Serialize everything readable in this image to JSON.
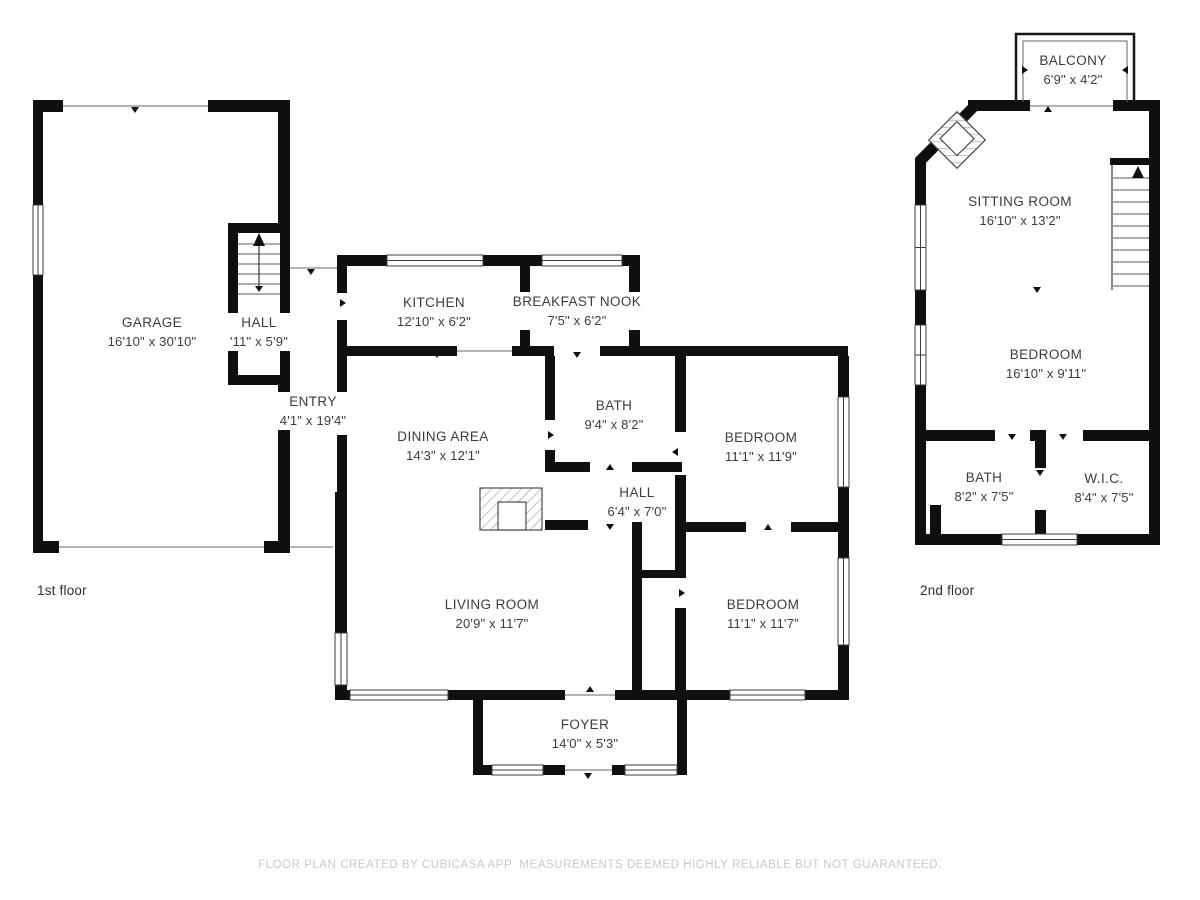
{
  "floors": [
    {
      "caption": "1st floor",
      "rooms": [
        {
          "id": "garage",
          "name": "GARAGE",
          "dims": "16'10\" x 30'10\""
        },
        {
          "id": "stair-hall",
          "name": "HALL",
          "dims": "'11\" x 5'9\""
        },
        {
          "id": "entry",
          "name": "ENTRY",
          "dims": "4'1\" x 19'4\""
        },
        {
          "id": "kitchen",
          "name": "KITCHEN",
          "dims": "12'10\" x 6'2\""
        },
        {
          "id": "breakfast-nook",
          "name": "BREAKFAST NOOK",
          "dims": "7'5\" x 6'2\""
        },
        {
          "id": "dining-area",
          "name": "DINING AREA",
          "dims": "14'3\" x 12'1\""
        },
        {
          "id": "bath",
          "name": "BATH",
          "dims": "9'4\" x 8'2\""
        },
        {
          "id": "hall",
          "name": "HALL",
          "dims": "6'4\" x 7'0\""
        },
        {
          "id": "bedroom-1",
          "name": "BEDROOM",
          "dims": "11'1\" x 11'9\""
        },
        {
          "id": "living-room",
          "name": "LIVING ROOM",
          "dims": "20'9\" x 11'7\""
        },
        {
          "id": "bedroom-2",
          "name": "BEDROOM",
          "dims": "11'1\" x 11'7\""
        },
        {
          "id": "foyer",
          "name": "FOYER",
          "dims": "14'0\" x 5'3\""
        }
      ]
    },
    {
      "caption": "2nd floor",
      "rooms": [
        {
          "id": "balcony",
          "name": "BALCONY",
          "dims": "6'9\" x 4'2\""
        },
        {
          "id": "sitting-room",
          "name": "SITTING ROOM",
          "dims": "16'10\" x 13'2\""
        },
        {
          "id": "bedroom-3",
          "name": "BEDROOM",
          "dims": "16'10\" x 9'11\""
        },
        {
          "id": "bath-2",
          "name": "BATH",
          "dims": "8'2\" x 7'5\""
        },
        {
          "id": "wic",
          "name": "W.I.C.",
          "dims": "8'4\" x 7'5\""
        }
      ]
    }
  ],
  "footer": "FLOOR PLAN CREATED BY CUBICASA APP  MEASUREMENTS DEEMED HIGHLY RELIABLE BUT NOT GUARANTEED.",
  "colors": {
    "wall": "#0f0f0f",
    "label_text": "#3c3c3c",
    "footer_text": "#c9c9c9",
    "opening_line": "#9a9a9a"
  }
}
